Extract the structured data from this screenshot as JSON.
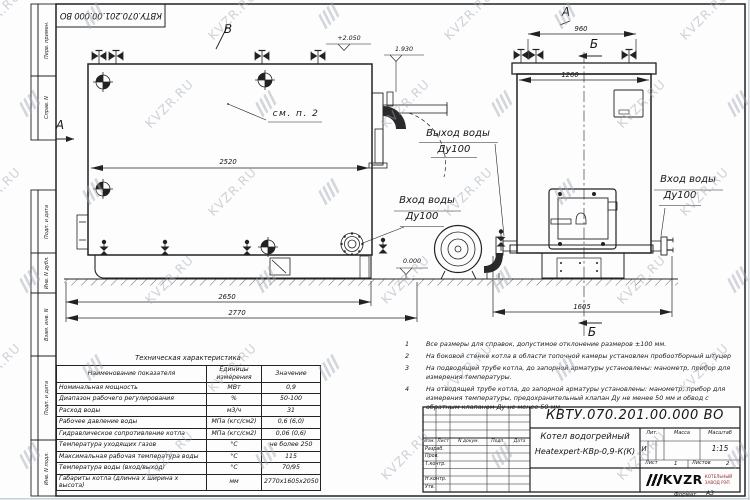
{
  "watermark": {
    "text": "KVZR.RU"
  },
  "colors": {
    "line": "#222222",
    "logo_red": "#8a2f2b",
    "watermark": "#9fa8b2"
  },
  "frame": {
    "designation_rotated": "КВТУ.070.201.00.000  ВО",
    "format_label": "Формат",
    "format_value": "А3",
    "stamps": [
      {
        "label": "Перв. примен."
      },
      {
        "label": "Справ. N"
      },
      {
        "label": "Подп. и дата"
      },
      {
        "label": "Инв. N дубл."
      },
      {
        "label": "Взам. инв. N"
      },
      {
        "label": "Подп. и дата"
      },
      {
        "label": "Инв. N подл."
      }
    ]
  },
  "drawing": {
    "markers": {
      "a_left": "А",
      "b_top": "В",
      "a_right": "А",
      "b_right_top": "Б",
      "b_right_bottom": "Б"
    },
    "labels": {
      "see_note": "см. п. 2",
      "outlet_line1": "Выход воды",
      "outlet_line2": "Ду100",
      "inlet_line1": "Вход воды",
      "inlet_line2": "Ду100",
      "inlet_right_line1": "Вход воды",
      "inlet_right_line2": "Ду100"
    },
    "dimensions": {
      "side_length": "2520",
      "base_length": "2650",
      "total_length": "2770",
      "top_width": "960",
      "front_width": "1260",
      "depth": "1605"
    },
    "elevations": {
      "top": "+2.050",
      "outlet": "1.930",
      "ground": "0.000"
    }
  },
  "tech_table": {
    "title": "Техническая характеристика",
    "headers": [
      "Наименование показателя",
      "Единицы измерения",
      "Значение"
    ],
    "rows": [
      {
        "name": "Номинальная мощность",
        "unit": "МВт",
        "value": "0,9"
      },
      {
        "name": "Диапазон рабочего регулирования",
        "unit": "%",
        "value": "50-100"
      },
      {
        "name": "Расход воды",
        "unit": "м3/ч",
        "value": "31"
      },
      {
        "name": "Рабочее давление воды",
        "unit": "МПа (кгс/см2)",
        "value": "0,6 (6,0)"
      },
      {
        "name": "Гидравлическое сопротивление котла",
        "unit": "МПа (кгс/см2)",
        "value": "0,06 (0,6)"
      },
      {
        "name": "Температура уходящих газов",
        "unit": "°С",
        "value": "не более 250"
      },
      {
        "name": "Максимальная рабочая температура воды",
        "unit": "°С",
        "value": "115"
      },
      {
        "name": "Температура воды (вход/выход)",
        "unit": "°С",
        "value": "70/95"
      },
      {
        "name": "Габариты котла (длинна х ширина х высота)",
        "unit": "мм",
        "value": "2770х1605х2050"
      }
    ]
  },
  "notes": {
    "items": [
      {
        "num": "1",
        "text": "Все размеры для справок, допустимое отклонение размеров ±100 мм."
      },
      {
        "num": "2",
        "text": "На боковой стенке котла в области топочной камеры установлен пробоотборный штуцер"
      },
      {
        "num": "3",
        "text": "На  подводящей трубе котла, до запорной арматуры установлены: манометр, прибор для измерения температуры."
      },
      {
        "num": "4",
        "text": "На отводящей трубе котла, до запорной арматуры установлены: манометр, прибор для измерения температуры, предохранительный клапан Ду не менее 50 мм и обвод с обратным клапаном Ду не менее 50 мм."
      }
    ]
  },
  "title_block": {
    "designation": "КВТУ.070.201.00.000  ВО",
    "columns": {
      "izm": "Изм.",
      "list": "Лист",
      "doc": "N докум.",
      "podp": "Подп.",
      "data": "Дата"
    },
    "rows": {
      "razrab": "Разраб.",
      "prov": "Пров.",
      "tkontr": "Т.контр.",
      "nkontr": "Н.контр.",
      "utv": "Утв."
    },
    "product_line1": "Котел водогрейный",
    "product_line2": "Heatexpert-КВр-0,9-К(К)",
    "lit_label": "Лит.",
    "mass_label": "Масса",
    "scale_label": "Масштаб",
    "lit_value": "И",
    "scale_value": "1:15",
    "sheet_label": "Лист",
    "sheet_value": "1",
    "sheets_label": "Листов",
    "sheets_value": "2",
    "logo_text": "KVZR",
    "company_line1": "КОТЕЛЬНЫЙ",
    "company_line2": "ЗАВОД РЭП"
  }
}
